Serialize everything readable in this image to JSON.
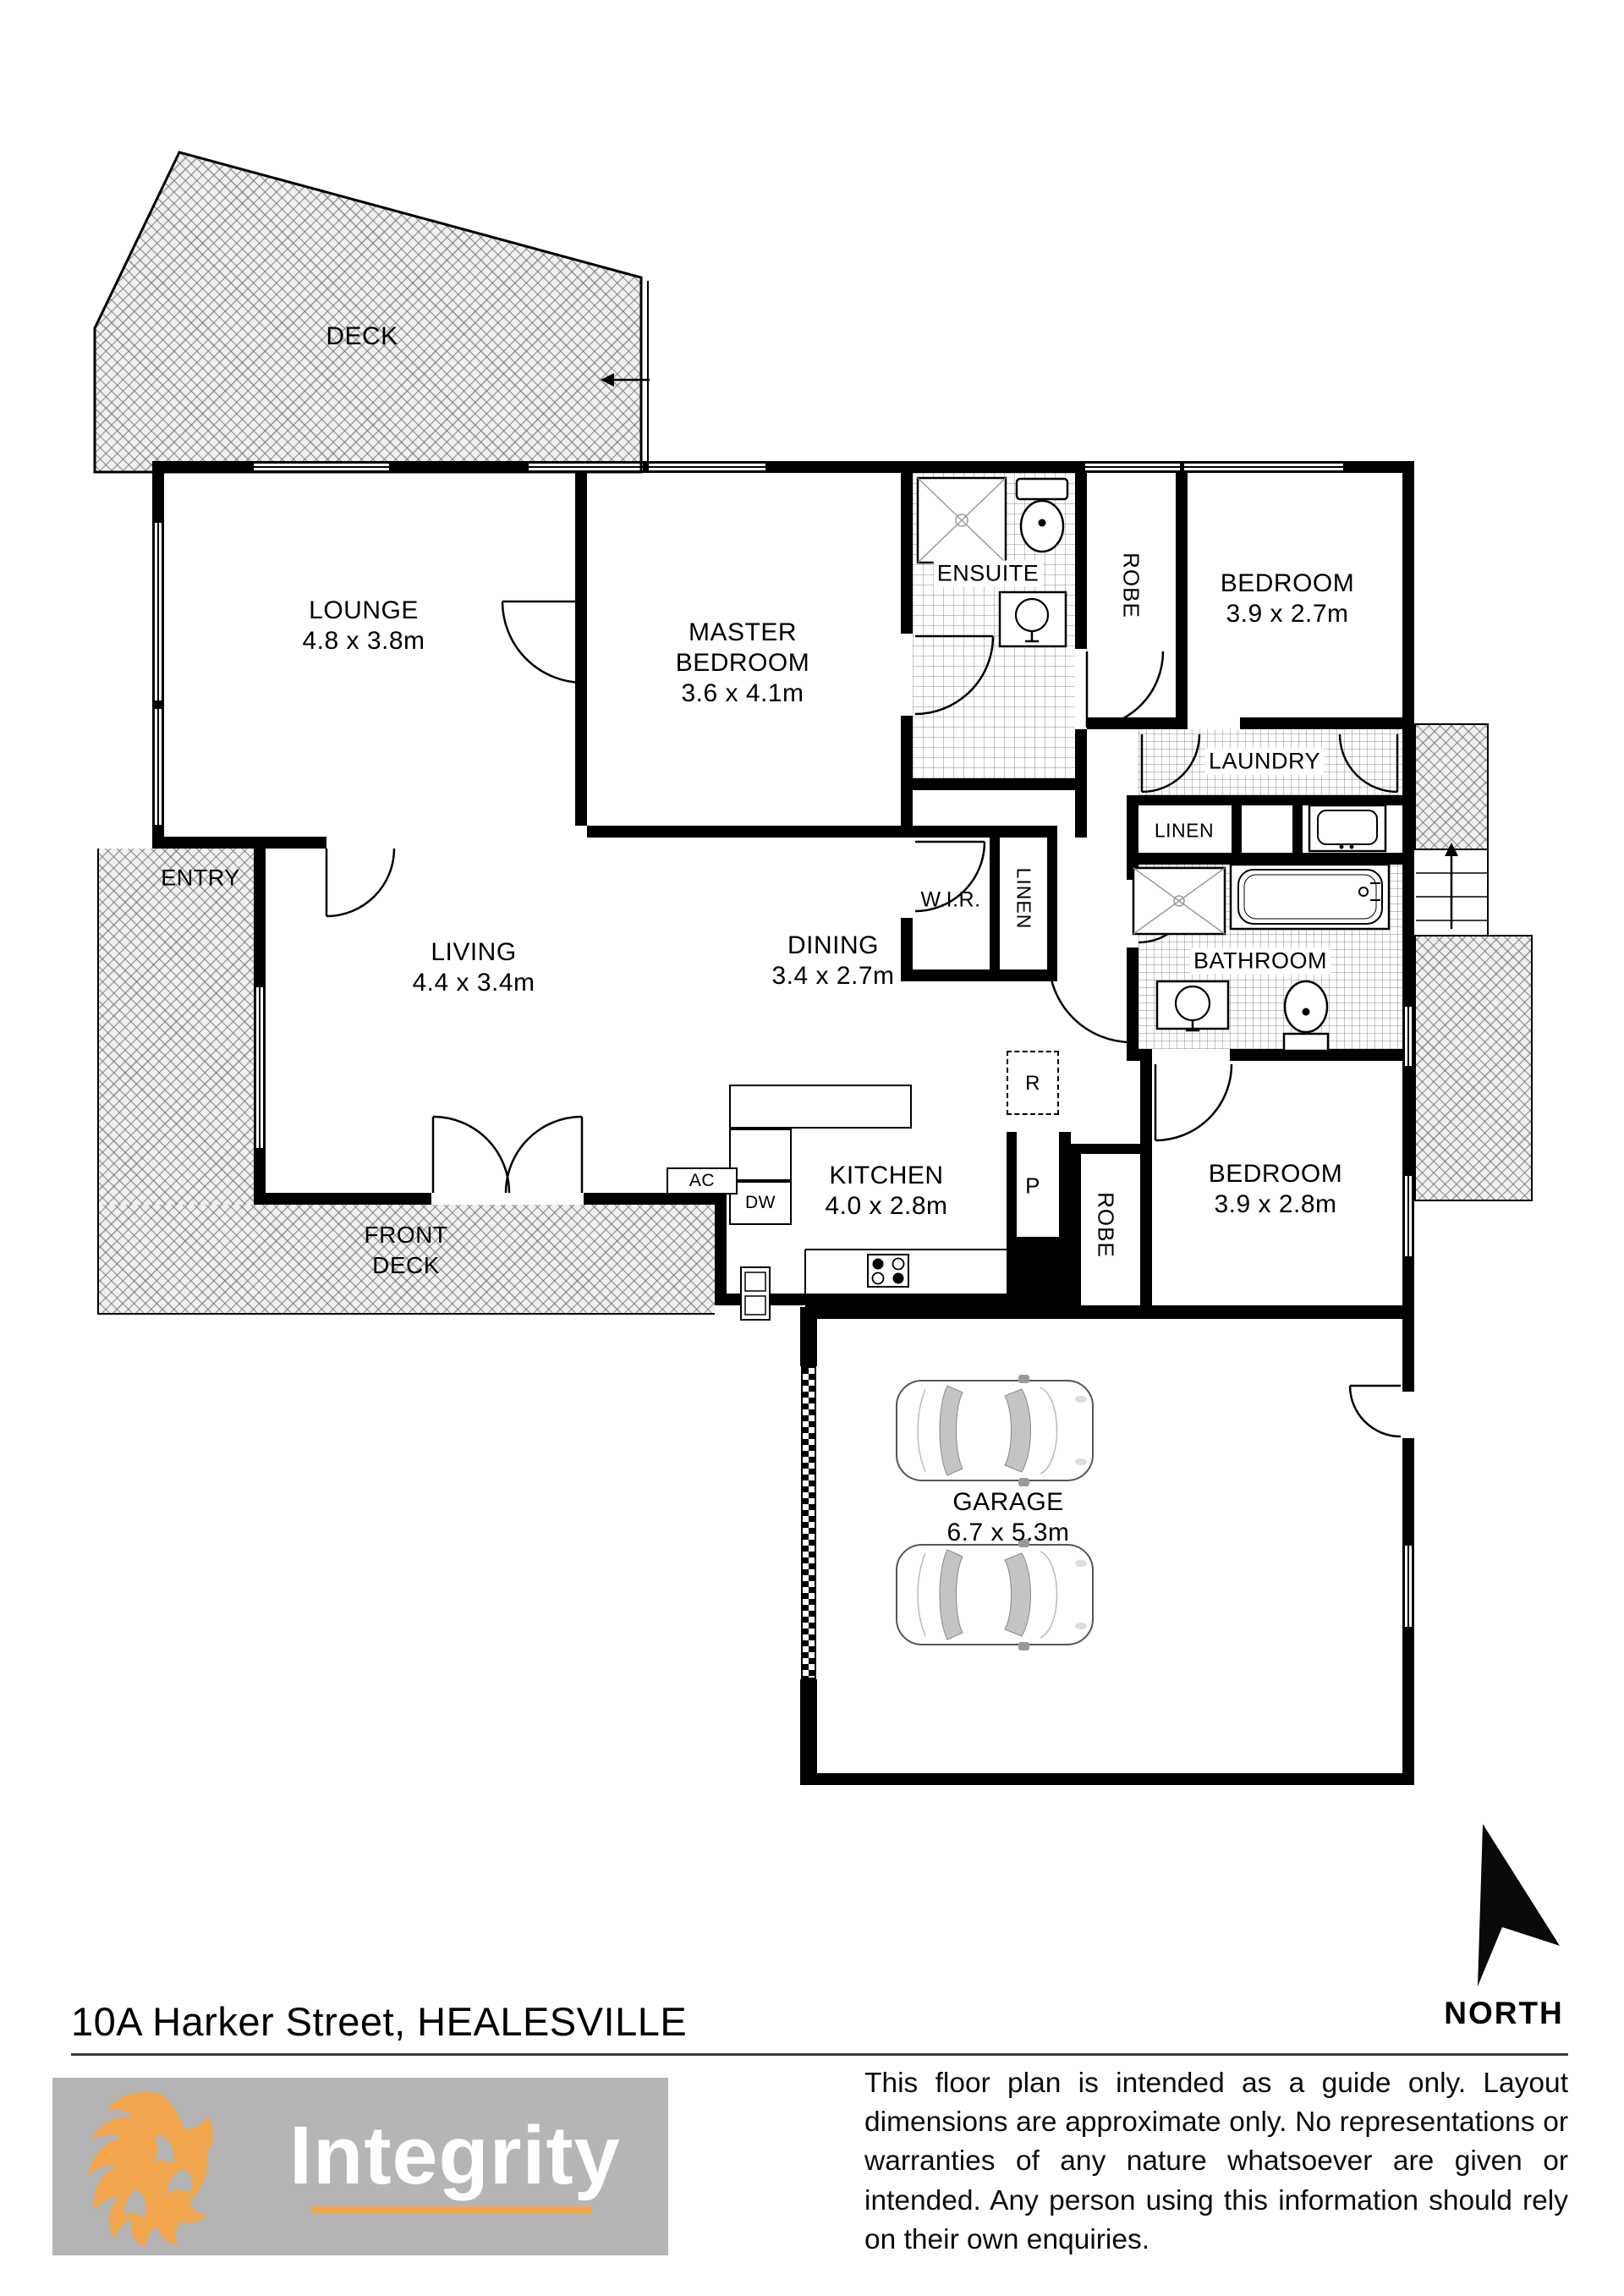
{
  "title": {
    "address": "10A Harker Street, HEALESVILLE"
  },
  "compass": {
    "label": "NORTH"
  },
  "brand": {
    "logo_text": "Integrity"
  },
  "disclaimer": {
    "text": "This floor plan is intended as a guide only. Layout dimensions are approximate only. No representations or warranties of any nature whatsoever are given or intended. Any person using this information should rely on their own enquiries."
  },
  "rooms": {
    "deck": {
      "name": "DECK"
    },
    "lounge": {
      "name": "LOUNGE",
      "dims": "4.8 x 3.8m"
    },
    "master_bedroom": {
      "line1": "MASTER",
      "line2": "BEDROOM",
      "dims": "3.6 x 4.1m"
    },
    "ensuite": {
      "name": "ENSUITE"
    },
    "robe_rear": {
      "name": "ROBE"
    },
    "bedroom_rear": {
      "name": "BEDROOM",
      "dims": "3.9 x 2.7m"
    },
    "laundry": {
      "name": "LAUNDRY"
    },
    "linen_laundry": {
      "name": "LINEN"
    },
    "wir": {
      "name": "W.I.R."
    },
    "linen_hall": {
      "name": "LINEN"
    },
    "bathroom": {
      "name": "BATHROOM"
    },
    "entry": {
      "name": "ENTRY"
    },
    "living": {
      "name": "LIVING",
      "dims": "4.4 x 3.4m"
    },
    "dining": {
      "name": "DINING",
      "dims": "3.4 x 2.7m"
    },
    "kitchen": {
      "name": "KITCHEN",
      "dims": "4.0 x 2.8m"
    },
    "robe_front": {
      "name": "ROBE"
    },
    "bedroom_front": {
      "name": "BEDROOM",
      "dims": "3.9 x 2.8m"
    },
    "front_deck": {
      "line1": "FRONT",
      "line2": "DECK"
    },
    "garage": {
      "name": "GARAGE",
      "dims": "6.7 x 5.3m"
    }
  },
  "fixtures": {
    "ac": "AC",
    "dishwasher": "DW",
    "fridge": "R",
    "pantry": "P"
  }
}
